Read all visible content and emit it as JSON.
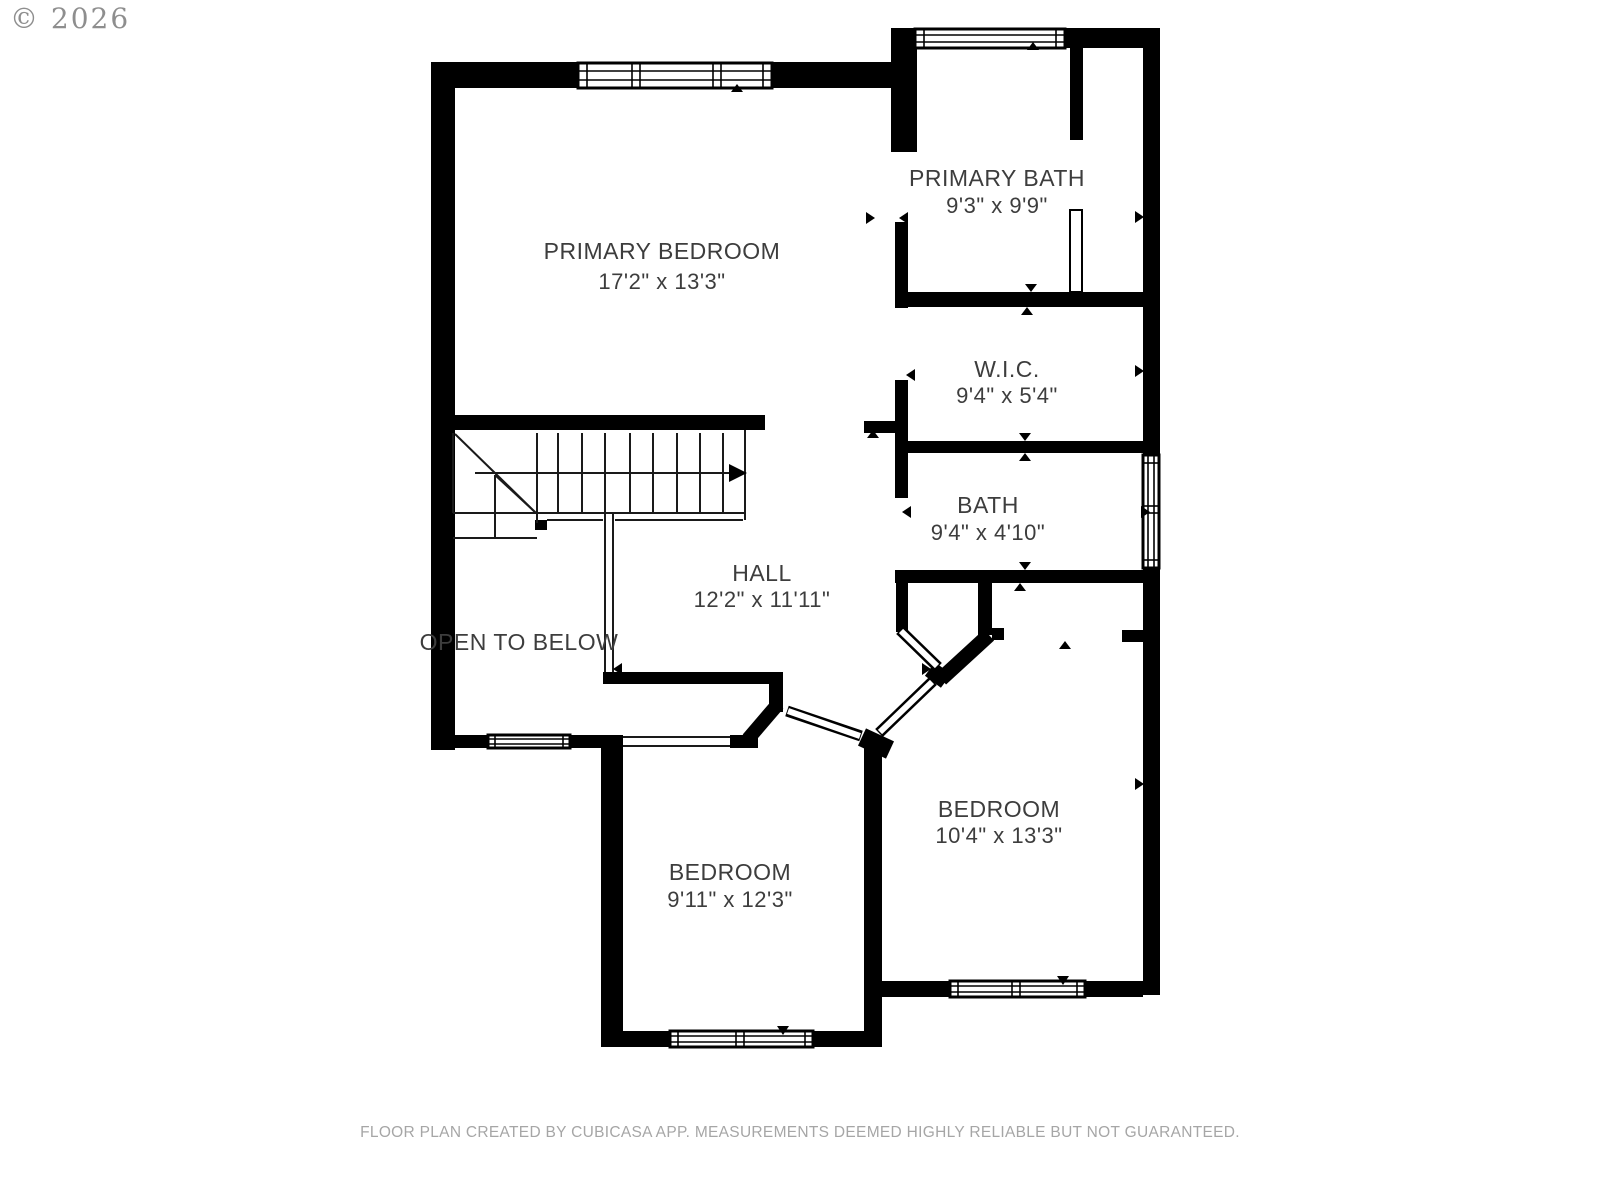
{
  "copyright": "© 2026",
  "footer": "FLOOR PLAN CREATED BY CUBICASA APP. MEASUREMENTS DEEMED HIGHLY RELIABLE BUT NOT GUARANTEED.",
  "colors": {
    "wall": "#000000",
    "label": "#3d3d3d",
    "watermark": "#7b7b7b",
    "footer": "#a6a6a6",
    "background": "#ffffff"
  },
  "rooms": {
    "primary_bedroom": {
      "name": "PRIMARY BEDROOM",
      "dims": "17'2\" x 13'3\""
    },
    "primary_bath": {
      "name": "PRIMARY BATH",
      "dims": "9'3\" x 9'9\""
    },
    "wic": {
      "name": "W.I.C.",
      "dims": "9'4\" x 5'4\""
    },
    "bath": {
      "name": "BATH",
      "dims": "9'4\" x 4'10\""
    },
    "hall": {
      "name": "HALL",
      "dims": "12'2\" x 11'11\""
    },
    "bedroom_left": {
      "name": "BEDROOM",
      "dims": "9'11\" x 12'3\""
    },
    "bedroom_right": {
      "name": "BEDROOM",
      "dims": "10'4\" x 13'3\""
    },
    "open_to_below": {
      "name": "OPEN TO BELOW"
    }
  }
}
